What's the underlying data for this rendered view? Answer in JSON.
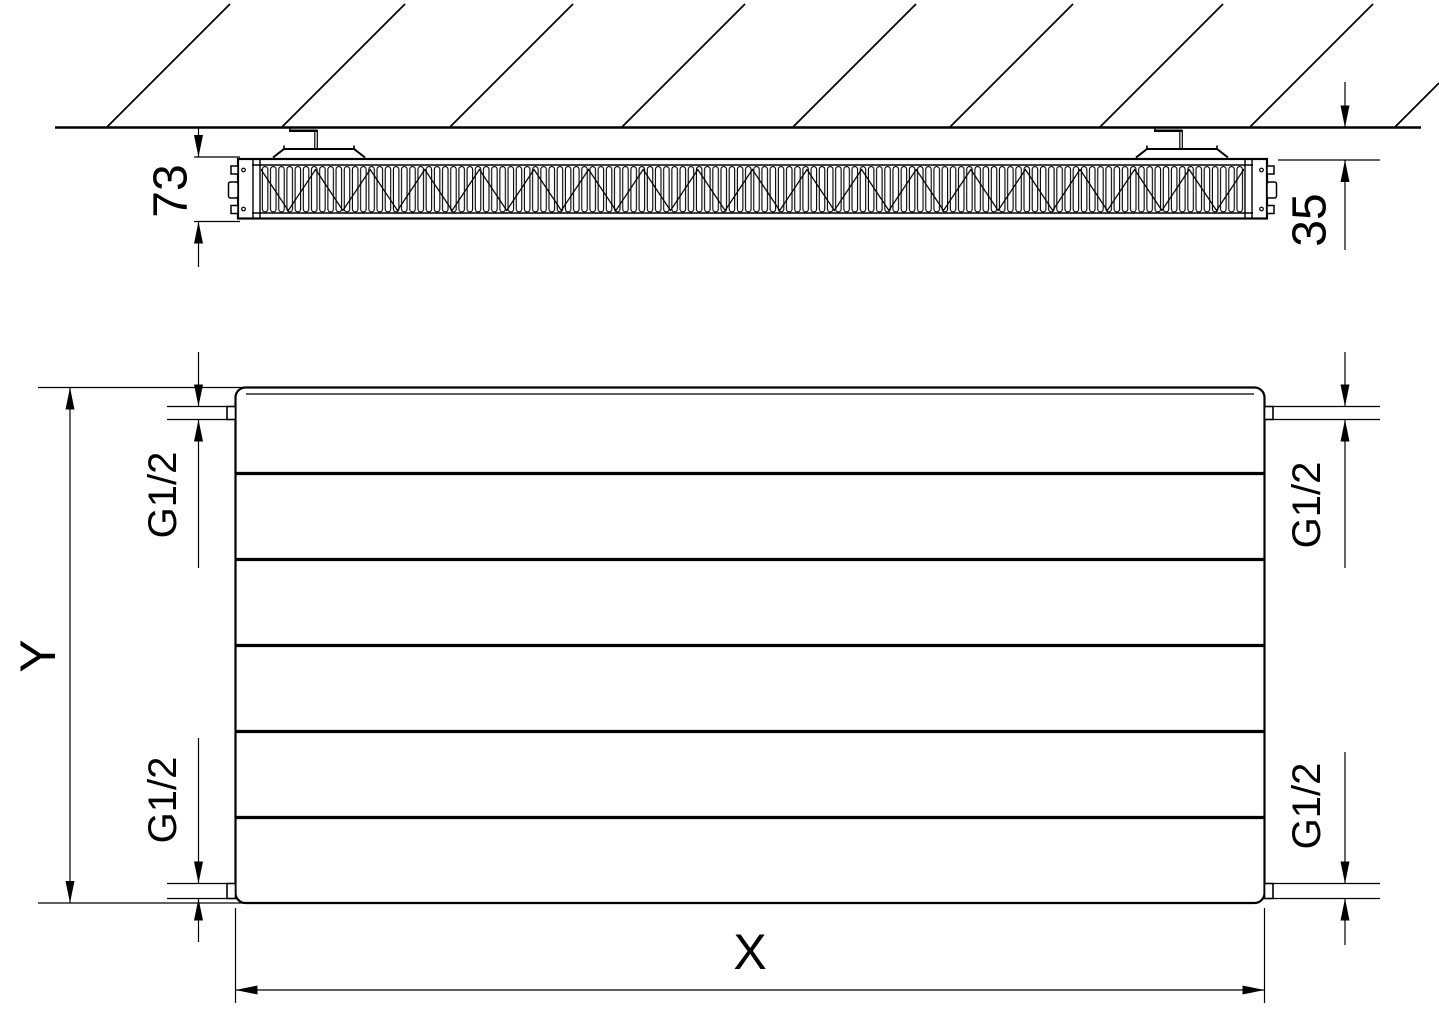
{
  "drawing": {
    "top_view": {
      "depth_label": "73",
      "wall_gap_label": "35"
    },
    "front_view": {
      "height_label": "Y",
      "width_label": "X",
      "thread_top_left": "G1/2",
      "thread_bottom_left": "G1/2",
      "thread_top_right": "G1/2",
      "thread_bottom_right": "G1/2"
    },
    "colors": {
      "line": "#000000",
      "background": "#ffffff"
    }
  }
}
